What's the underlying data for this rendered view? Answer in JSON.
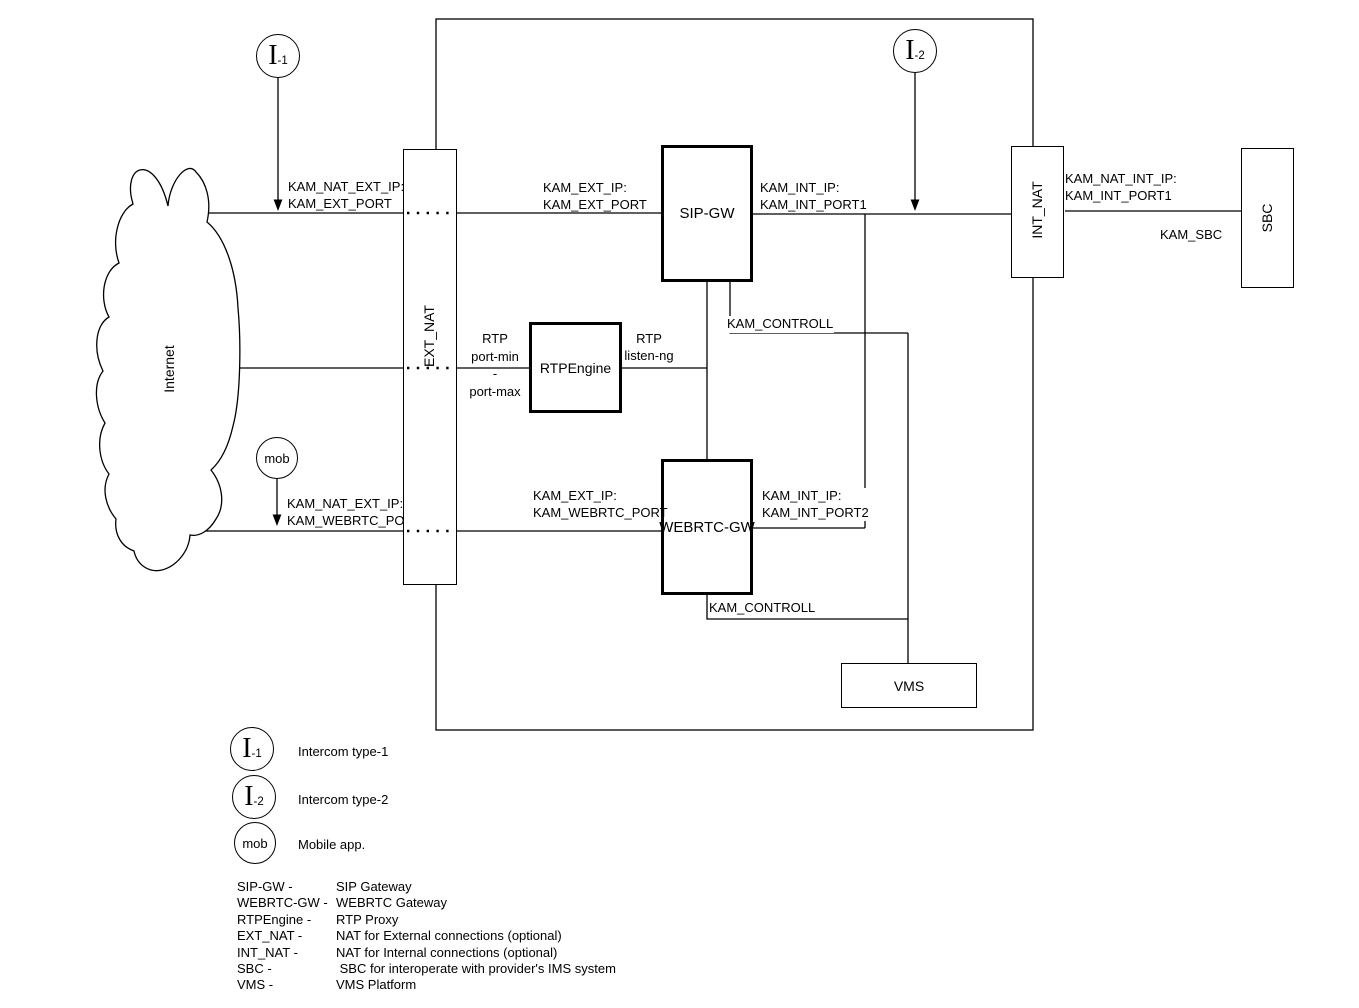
{
  "diagram": {
    "cloud_label": "Internet",
    "boxes": {
      "ext_nat": "EXT_NAT",
      "int_nat": "INT_NAT",
      "sbc": "SBC",
      "sip_gw": "SIP-GW",
      "rtpengine": "RTPEngine",
      "webrtc_gw": "WEBRTC-GW",
      "vms": "VMS"
    },
    "nodes": {
      "i1_main": "I",
      "i1_sub": "-1",
      "i2_main": "I",
      "i2_sub": "-2",
      "mob": "mob"
    },
    "edge_labels": {
      "nat_ext_1": [
        "KAM_NAT_EXT_IP:",
        "KAM_EXT_PORT"
      ],
      "ext_ip_sip": [
        "KAM_EXT_IP:",
        "KAM_EXT_PORT"
      ],
      "int_ip_sip": [
        "KAM_INT_IP:",
        "KAM_INT_PORT1"
      ],
      "nat_int": [
        "KAM_NAT_INT_IP:",
        "KAM_INT_PORT1"
      ],
      "kam_sbc": "KAM_SBC",
      "controll_sip": "KAM_CONTROLL",
      "controll_webrtc": "KAM_CONTROLL",
      "rtp_ports": [
        "RTP",
        "port-min",
        "-",
        "port-max"
      ],
      "rtp_listen": [
        "RTP",
        "listen-ng"
      ],
      "ext_ip_webrtc": [
        "KAM_EXT_IP:",
        "KAM_WEBRTC_PORT"
      ],
      "int_ip_webrtc": [
        "KAM_INT_IP:",
        "KAM_INT_PORT2"
      ],
      "nat_ext_mob": [
        "KAM_NAT_EXT_IP:",
        "KAM_WEBRTC_PORT"
      ]
    }
  },
  "legend": {
    "items": [
      {
        "symbol_main": "I",
        "symbol_sub": "-1",
        "label": "Intercom type-1"
      },
      {
        "symbol_main": "I",
        "symbol_sub": "-2",
        "label": "Intercom type-2"
      },
      {
        "symbol_text": "mob",
        "label": "Mobile app."
      }
    ],
    "glossary": [
      {
        "term": "SIP-GW -",
        "desc": "SIP Gateway"
      },
      {
        "term": "WEBRTC-GW -",
        "desc": "WEBRTC Gateway"
      },
      {
        "term": "RTPEngine -",
        "desc": "RTP Proxy"
      },
      {
        "term": "EXT_NAT -",
        "desc": "NAT for External connections (optional)"
      },
      {
        "term": "INT_NAT -",
        "desc": "NAT for Internal connections (optional)"
      },
      {
        "term": "SBC -",
        "desc": " SBC for interoperate with provider's IMS system"
      },
      {
        "term": "VMS -",
        "desc": "VMS Platform"
      }
    ]
  },
  "colors": {
    "stroke": "#000000",
    "background": "#ffffff"
  }
}
